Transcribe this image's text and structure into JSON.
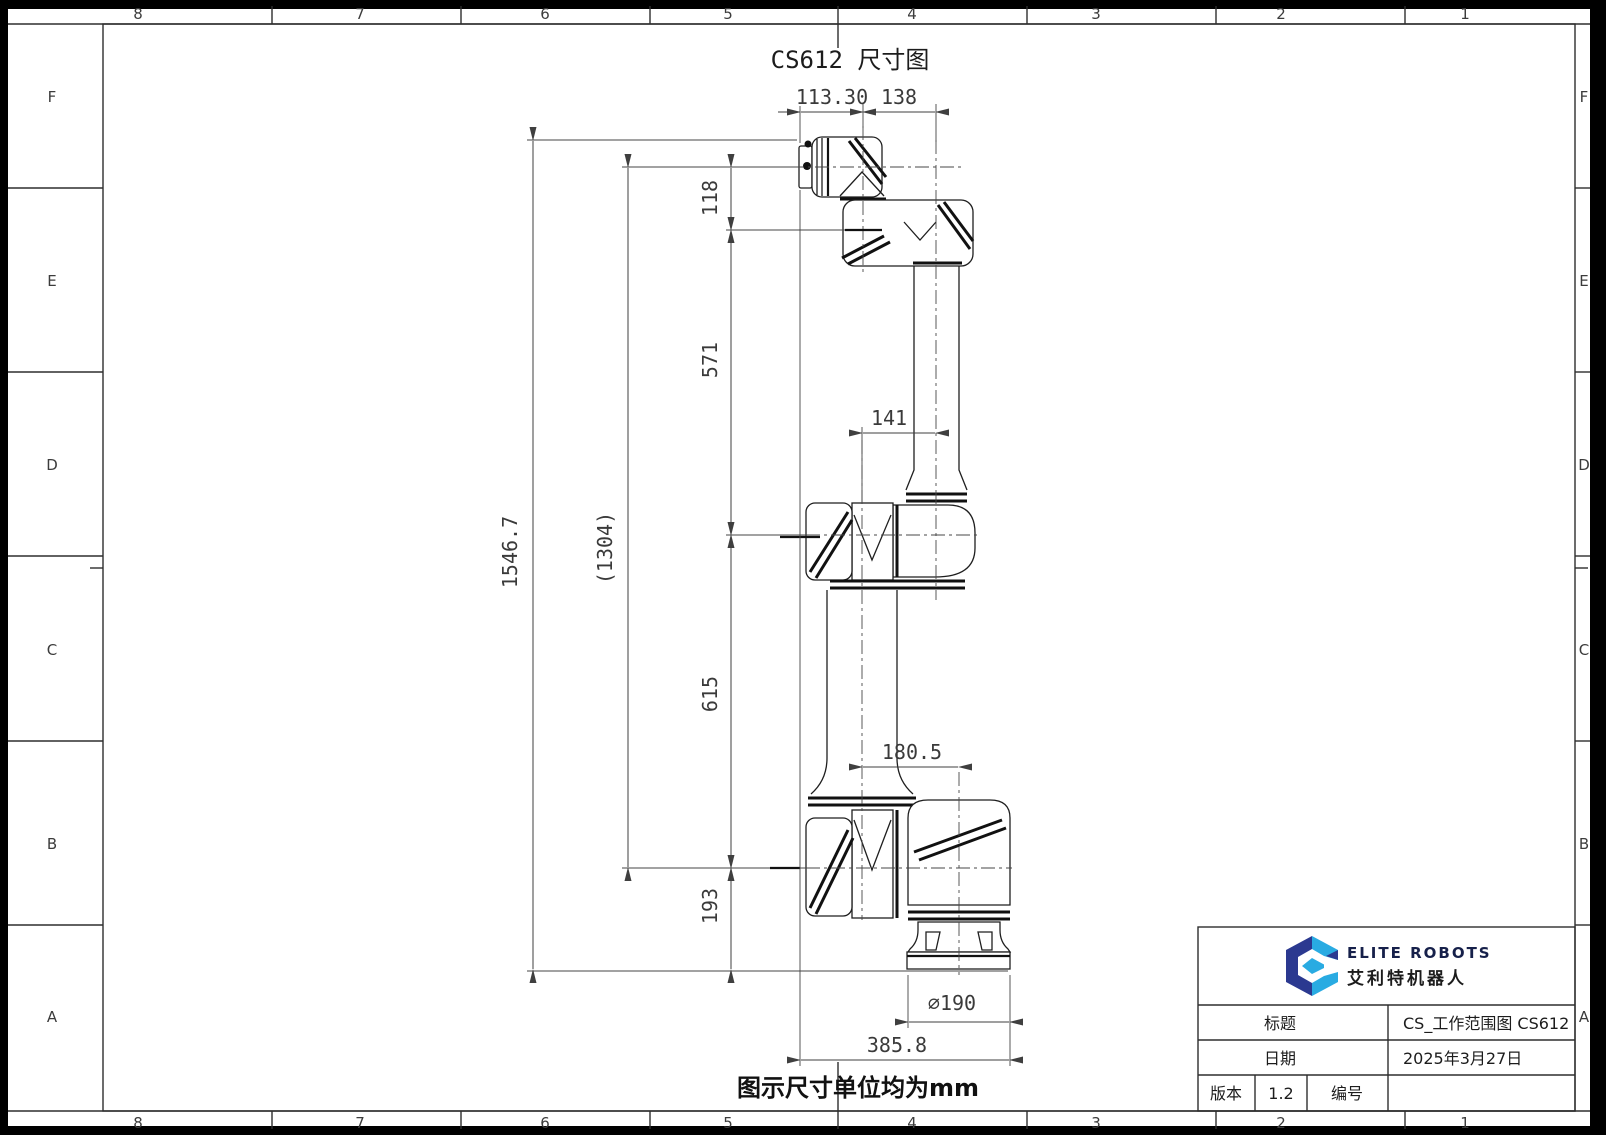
{
  "page": {
    "title": "CS612 尺寸图",
    "note": "图示尺寸单位均为mm"
  },
  "zones": {
    "cols": [
      "8",
      "7",
      "6",
      "5",
      "4",
      "3",
      "2",
      "1"
    ],
    "rows": [
      "F",
      "E",
      "D",
      "C",
      "B",
      "A"
    ]
  },
  "dims": {
    "d113": "113.30",
    "d138": "138",
    "d118": "118",
    "d571": "571",
    "d141": "141",
    "d1546": "1546.7",
    "d1304": "(1304)",
    "d615": "615",
    "d180": "180.5",
    "d193": "193",
    "d190": "⌀190",
    "d385": "385.8"
  },
  "title_block": {
    "brand_en": "ELITE ROBOTS",
    "brand_cn": "艾利特机器人",
    "title_label": "标题",
    "title_value": "CS_工作范围图 CS612",
    "date_label": "日期",
    "date_value": "2025年3月27日",
    "version_label": "版本",
    "version_value": "1.2",
    "number_label": "编号",
    "number_value": ""
  },
  "colors": {
    "logo_navy": "#2b3990",
    "logo_blue": "#29abe2",
    "paper": "#ffffff"
  }
}
